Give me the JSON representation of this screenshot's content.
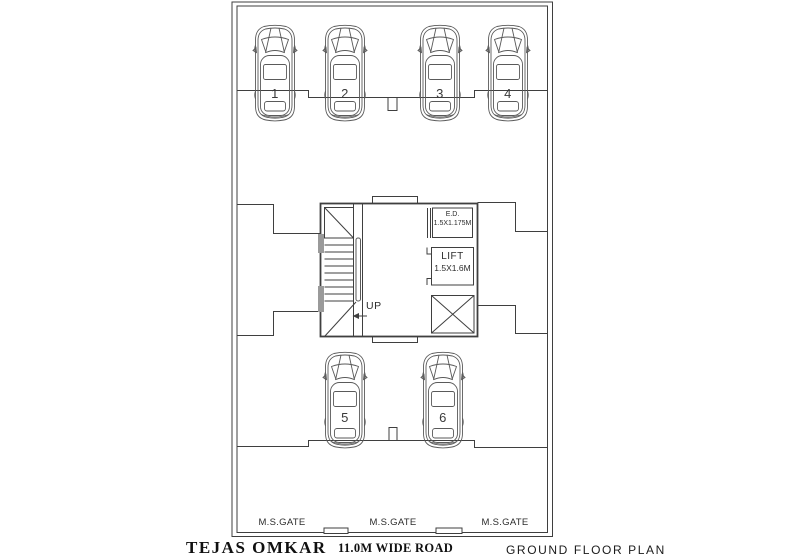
{
  "drawing": {
    "title": "GROUND FLOOR PLAN",
    "project_name": "TEJAS OMKAR",
    "road_label": "11.0M WIDE ROAD"
  },
  "plan": {
    "parking_spots": [
      {
        "number": "1"
      },
      {
        "number": "2"
      },
      {
        "number": "3"
      },
      {
        "number": "4"
      },
      {
        "number": "5"
      },
      {
        "number": "6"
      }
    ],
    "stair": {
      "direction_label": "UP"
    },
    "electrical_duct": {
      "name": "E.D.",
      "size": "1.5X1.175M"
    },
    "lift": {
      "name": "LIFT",
      "size": "1.5X1.6M"
    },
    "gates": [
      {
        "label": "M.S.GATE"
      },
      {
        "label": "M.S.GATE"
      },
      {
        "label": "M.S.GATE"
      }
    ]
  },
  "colors": {
    "background": "#ffffff",
    "wall_line": "#3f3f3f",
    "car_line": "#5a5a5a",
    "wall_fill": "#9a9a9a",
    "text": "#1a1a1a"
  }
}
